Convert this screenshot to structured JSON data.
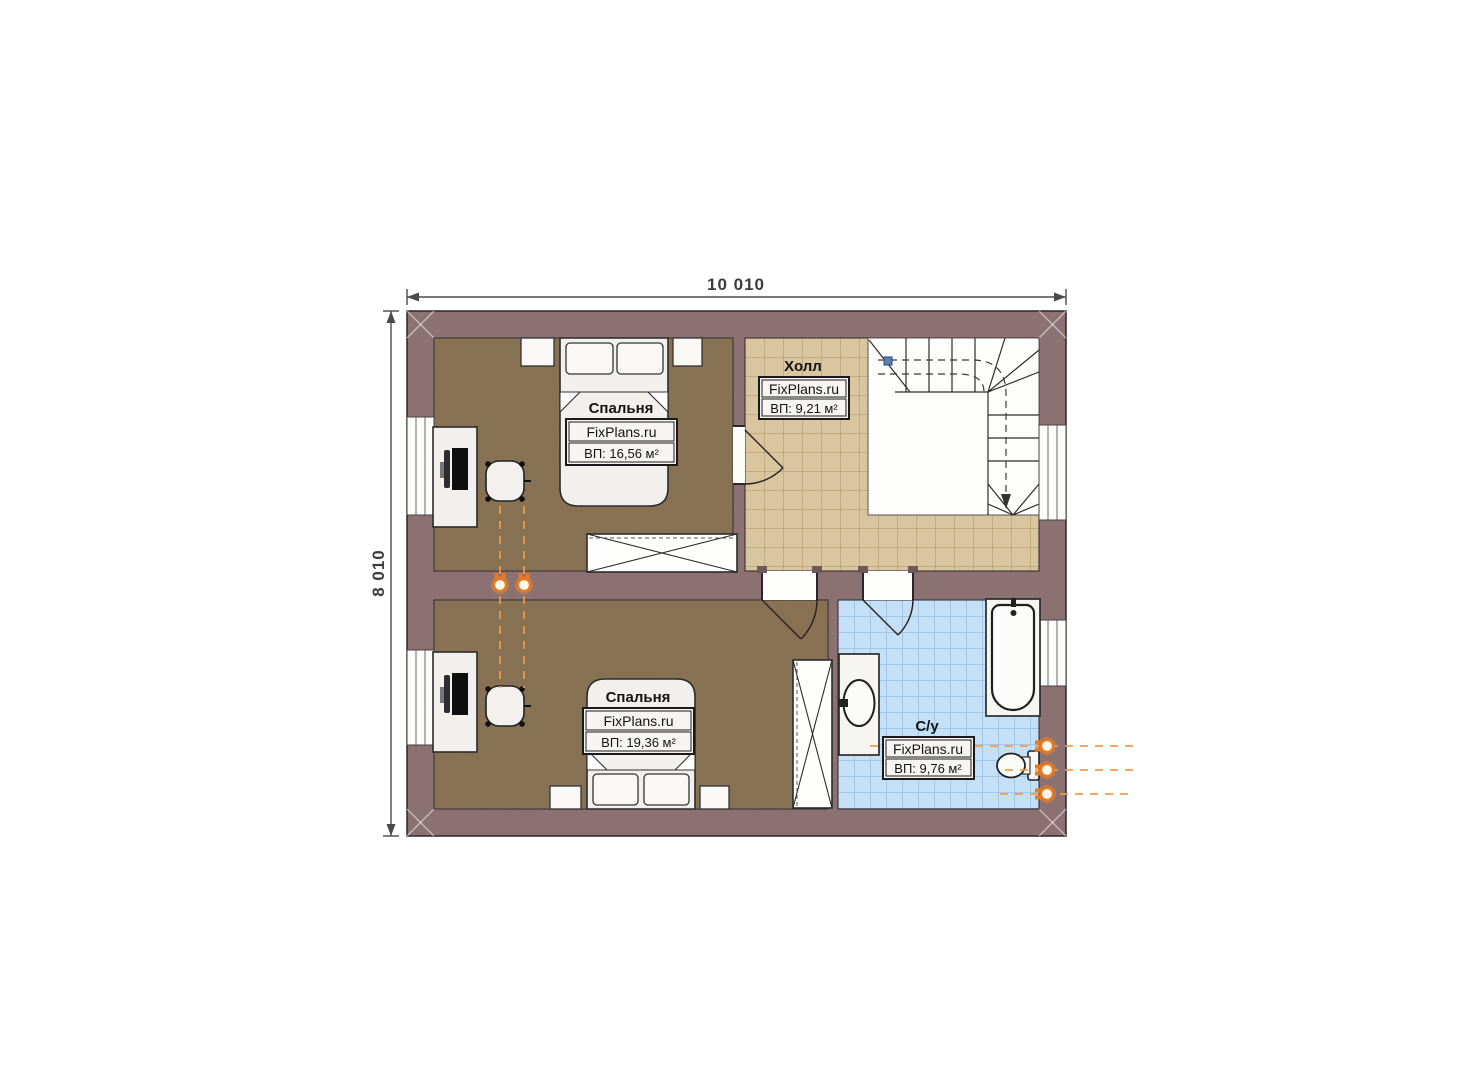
{
  "dimensions": {
    "top": "10 010",
    "left": "8 010"
  },
  "rooms": {
    "bedroom1": {
      "name": "Спальня",
      "brand": "FixPlans.ru",
      "area": "ВП: 16,56 м²"
    },
    "hall": {
      "name": "Холл",
      "brand": "FixPlans.ru",
      "area": "ВП: 9,21 м²"
    },
    "bedroom2": {
      "name": "Спальня",
      "brand": "FixPlans.ru",
      "area": "ВП: 19,36 м²"
    },
    "bathroom": {
      "name": "С/у",
      "brand": "FixPlans.ru",
      "area": "ВП: 9,76 м²"
    }
  },
  "colors": {
    "wall": "#8C7173",
    "bedroom_floor": "#8B7456",
    "hall_tile": "#D9C69E",
    "hall_grout": "#AD9168",
    "bath_tile": "#C3E0F7",
    "bath_grout": "#85AED4",
    "fixture": "#F4F3F0",
    "outline": "#2B2627",
    "accent_orange": "#ED7C1F"
  }
}
